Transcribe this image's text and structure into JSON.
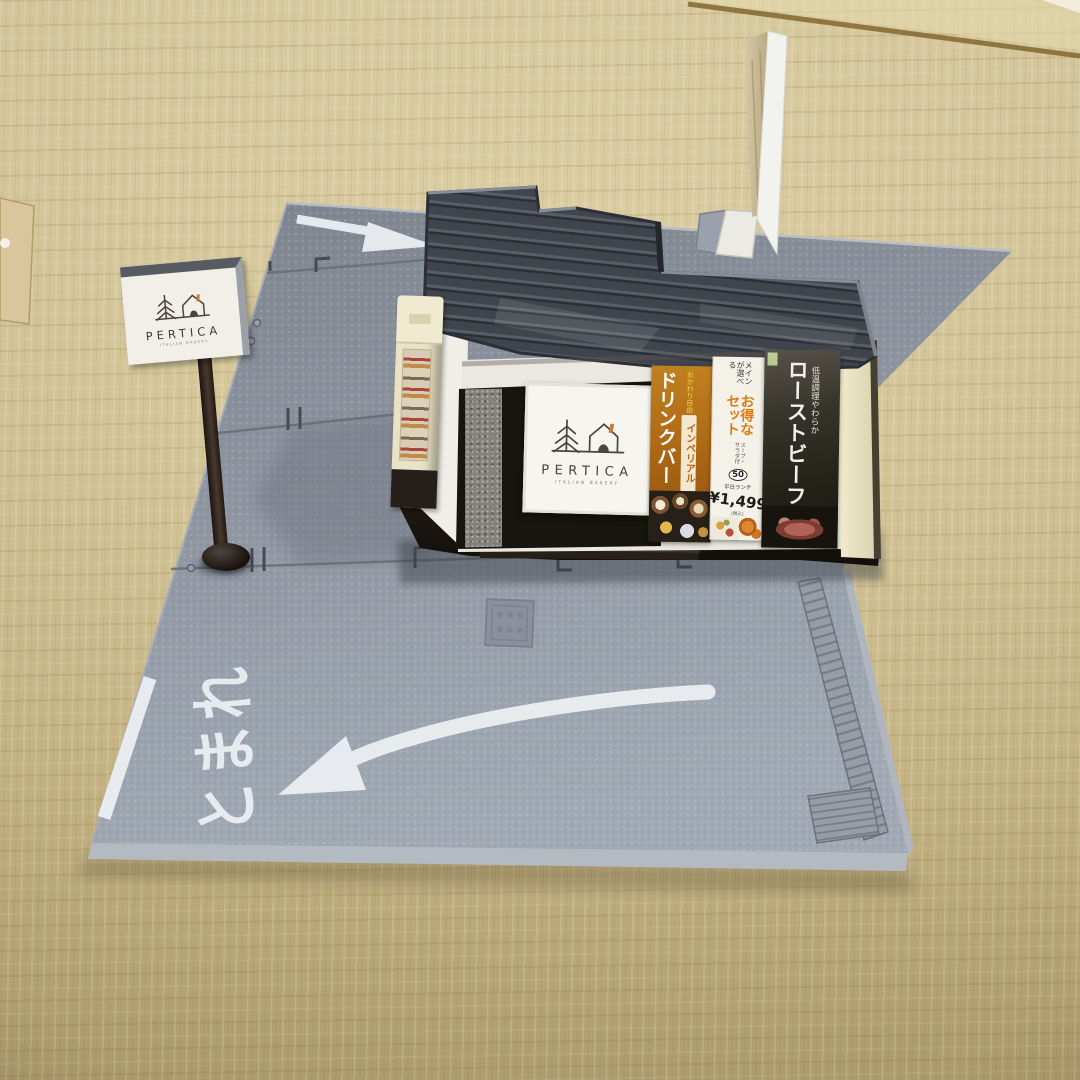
{
  "scene": {
    "title": "Miniature PERTICA restaurant diorama on gray parking-lot base plates, photographed on a tatami mat floor",
    "colors": {
      "tatami": "#d5c591",
      "plate_gray": "#929aa5",
      "roof_slate": "#41464d",
      "foundation_dark": "#1c1712",
      "cream_pillar": "#e9e2c4",
      "road_marking_white": "#edf0f3",
      "banner_orange": "#a96414",
      "banner_dark": "#242118",
      "set_title_orange": "#de7a14"
    }
  },
  "street_sign": {
    "brand": "PERTICA",
    "subtitle": "ITALIAN BAKERY"
  },
  "facade_sign": {
    "brand": "PERTICA",
    "subtitle": "ITALIAN BAKERY"
  },
  "banners": {
    "drink": {
      "title": "ドリンクバー",
      "brand_sub": "インペリアル",
      "note": "おかわり自由"
    },
    "set": {
      "lead": "メインが選べる",
      "title": "お得なセット",
      "items": "スープ・サラダ付",
      "badge": "50",
      "lunch": "平日ランチ",
      "price": "¥1,499",
      "tax_note": "(税込)"
    },
    "beef": {
      "title": "ローストビーフ",
      "sub": "低温調理やわらか"
    }
  },
  "road": {
    "stop_text": "とまれ"
  }
}
